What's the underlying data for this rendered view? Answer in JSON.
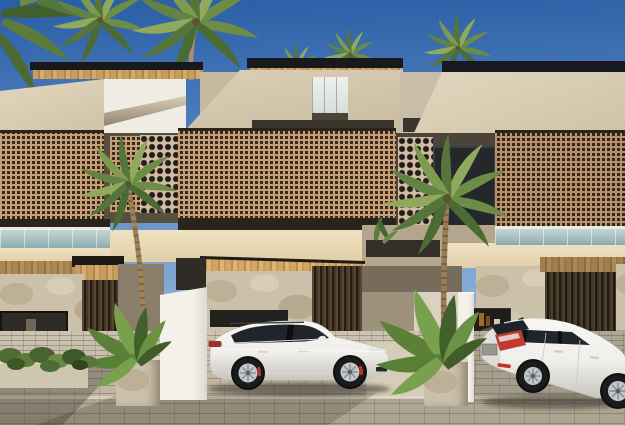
{
  "scene": {
    "title": "Row of modern two-storey tropical townhouses with perforated brick screens, coconut palms and two white cars parked on a brick paver driveway",
    "type": "3D architectural exterior render, daytime, clear blue sky",
    "buildings": {
      "storeys": 2,
      "features": [
        "flat dark roof edges with wooden slat soffits",
        "angled beige stucco upper volumes",
        "tan perforated lattice screens on balconies",
        "circular breeze-block columns",
        "glass balustrades over garages",
        "cream parapet bands",
        "limestone rubble stone walls at ground floor",
        "dark vertical wood slat doors and garage walls",
        "white partition walls between parking bays"
      ]
    },
    "cars": [
      {
        "label": "white Porsche-style compact SUV, side profile, facing right, red brake calipers, tinted windows"
      },
      {
        "label": "white compact crossover, rear three-quarter view, facing away to the right, red taillights and license plate"
      }
    ],
    "vegetation": [
      "coconut palm crowns above the roofline",
      "two foreground coconut palms in front of the lattice screens",
      "banana / bird-of-paradise plants in stone planters",
      "low green shrubs along the left stone wall",
      "small green tufts on the centre parapet"
    ],
    "ground": "grey-beige brick paver driveway and sidewalk with long horizontal curb joint and soft cast shadows"
  },
  "colors": {
    "sky_top": "#2b5da5",
    "sky_mid": "#5584c0",
    "sky_horizon": "#a3c2e2",
    "roof_dark": "#17191c",
    "soffit_wood": "#c89e60",
    "stucco_light": "#dccfb6",
    "stucco_shadow": "#b3a68c",
    "white_wall": "#f4f1e8",
    "lattice_tan": "#c79d74",
    "lattice_hole": "#352a1f",
    "circle_base": "#d2bda4",
    "circle_hole": "#241f19",
    "shadow_band": "#2a241c",
    "cream_band": "#e0cfa8",
    "glass_rail": "#9db8bb",
    "stone_base": "#cbc0aa",
    "slat_mid": "#564633",
    "slat_dark": "#241c12",
    "pave_light": "#ccc3b0",
    "pave_dark": "#b7ae9b",
    "palm_light": "#91a95c",
    "palm_mid": "#6d8c46",
    "palm_dark": "#4c6a34",
    "trunk_brown": "#a08257",
    "banana_green": "#5c8038",
    "car_white": "#f5f4f1",
    "car_glass": "#20252b",
    "rim_silver": "#c6c9cc",
    "brake_red": "#c23324",
    "tail_red": "#c23a2f"
  }
}
